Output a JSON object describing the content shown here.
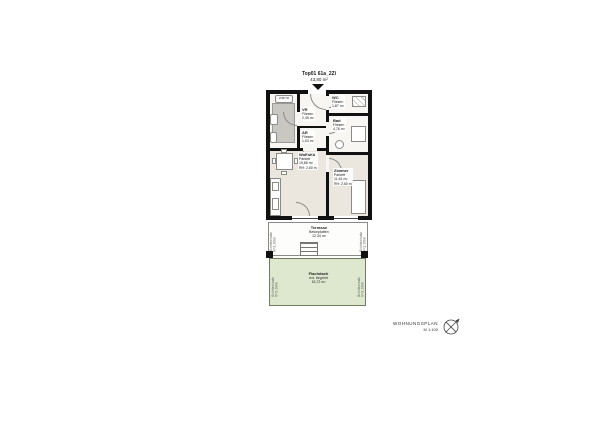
{
  "title": {
    "unit": "Top01 61a_2Zi",
    "area": "43,80 m²"
  },
  "rooms": {
    "vr": {
      "name": "VR",
      "floor": "Fliesen",
      "area": "2,45 m²"
    },
    "ar": {
      "name": "AR",
      "floor": "Fliesen",
      "area": "1,63 m²"
    },
    "wc": {
      "name": "WC",
      "floor": "Fliesen",
      "area": "1,87 m²"
    },
    "bad": {
      "name": "Bad",
      "floor": "Fliesen",
      "area": "4,76 m²"
    },
    "wohnkueche": {
      "name": "WoEsKü",
      "floor": "Parkett",
      "area": "19,86 m²",
      "height": "RH: 2,60 m"
    },
    "zimmer": {
      "name": "Zimmer",
      "floor": "Parkett",
      "area": "11,61 m²",
      "height": "RH: 2,60 m"
    },
    "terrasse": {
      "name": "Terrasse",
      "floor": "Betonplatten",
      "area": "12,34 m²"
    },
    "flachdach": {
      "name": "Flachdach",
      "floor": "ext. begrünt",
      "area": "15,72 m²"
    }
  },
  "annotations": {
    "appliance": "WM/TR",
    "screen_left": "Sichtschutz h=2,00m",
    "screen_right": "Sichtschutz h=2,00m"
  },
  "footer": {
    "label": "WOHNUNGSPLAN",
    "scale": "M 1:100"
  },
  "colors": {
    "wall": "#111111",
    "parquet": "#ebe7df",
    "tile": "#f7f6f3",
    "green_roof": "#dde8cf",
    "grey_block": "#c8c7c2"
  }
}
